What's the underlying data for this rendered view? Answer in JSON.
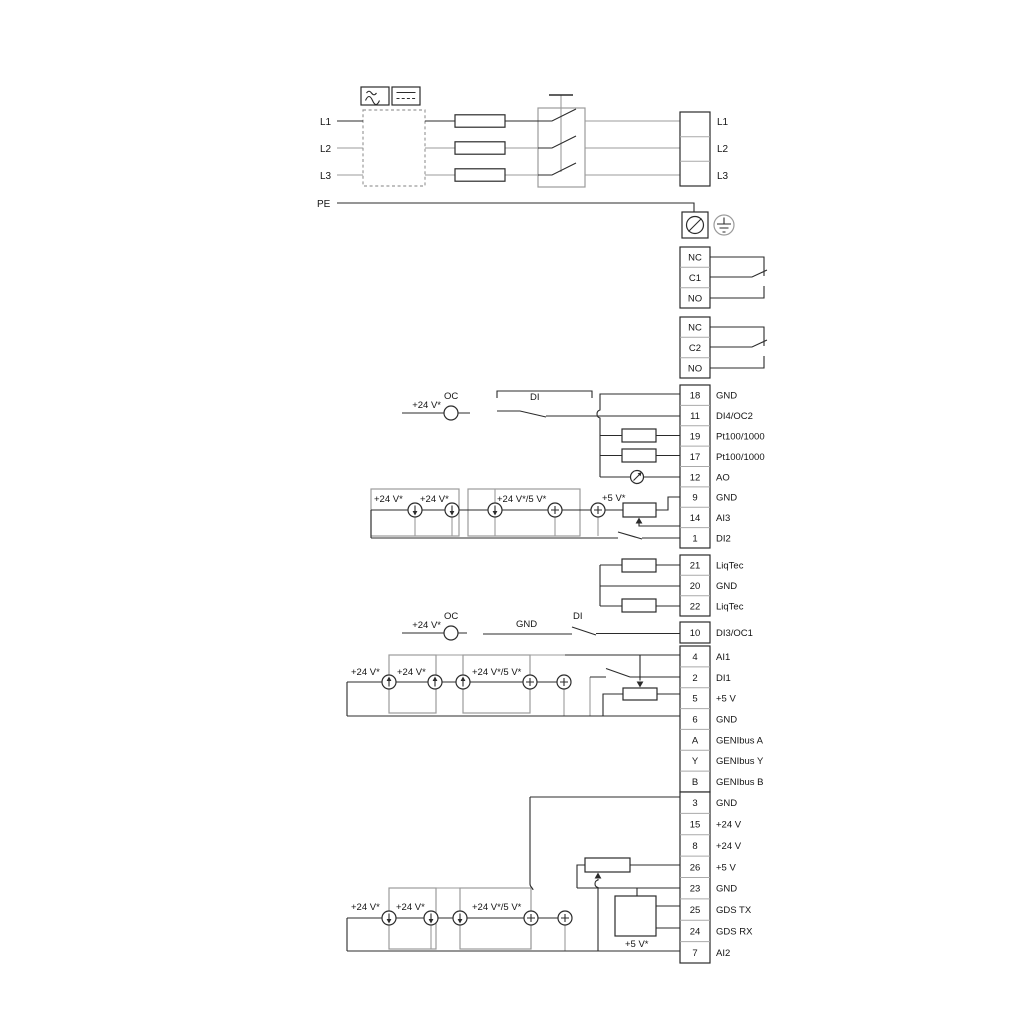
{
  "power": {
    "left": [
      "L1",
      "L2",
      "L3",
      "PE"
    ],
    "right": [
      "L1",
      "L2",
      "L3"
    ]
  },
  "relays": [
    {
      "rows": [
        "NC",
        "C1",
        "NO"
      ]
    },
    {
      "rows": [
        "NC",
        "C2",
        "NO"
      ]
    }
  ],
  "io_strip": [
    {
      "num": "18",
      "label": "GND"
    },
    {
      "num": "11",
      "label": "DI4/OC2"
    },
    {
      "num": "19",
      "label": "Pt100/1000"
    },
    {
      "num": "17",
      "label": "Pt100/1000"
    },
    {
      "num": "12",
      "label": "AO"
    },
    {
      "num": "9",
      "label": "GND"
    },
    {
      "num": "14",
      "label": "AI3"
    },
    {
      "num": "1",
      "label": "DI2"
    }
  ],
  "liqtec_strip": [
    {
      "num": "21",
      "label": "LiqTec"
    },
    {
      "num": "20",
      "label": "GND"
    },
    {
      "num": "22",
      "label": "LiqTec"
    }
  ],
  "di3_strip": [
    {
      "num": "10",
      "label": "DI3/OC1"
    }
  ],
  "ai1_strip": [
    {
      "num": "4",
      "label": "AI1"
    },
    {
      "num": "2",
      "label": "DI1"
    },
    {
      "num": "5",
      "label": "+5 V"
    },
    {
      "num": "6",
      "label": "GND"
    },
    {
      "num": "A",
      "label": "GENIbus A"
    },
    {
      "num": "Y",
      "label": "GENIbus Y"
    },
    {
      "num": "B",
      "label": "GENIbus B"
    }
  ],
  "bottom_strip": [
    {
      "num": "3",
      "label": "GND"
    },
    {
      "num": "15",
      "label": "+24 V"
    },
    {
      "num": "8",
      "label": "+24 V"
    },
    {
      "num": "26",
      "label": "+5 V"
    },
    {
      "num": "23",
      "label": "GND"
    },
    {
      "num": "25",
      "label": "GDS TX"
    },
    {
      "num": "24",
      "label": "GDS RX"
    },
    {
      "num": "7",
      "label": "AI2"
    }
  ],
  "ann": {
    "oc": "OC",
    "di": "DI",
    "gnd": "GND",
    "v24": "+24 V*",
    "v24_5": "+24 V*/5 V*",
    "v5": "+5 V*"
  },
  "colors": {
    "ink": "#2b2b2b",
    "gray": "#9b9b9b",
    "background": "#ffffff"
  }
}
